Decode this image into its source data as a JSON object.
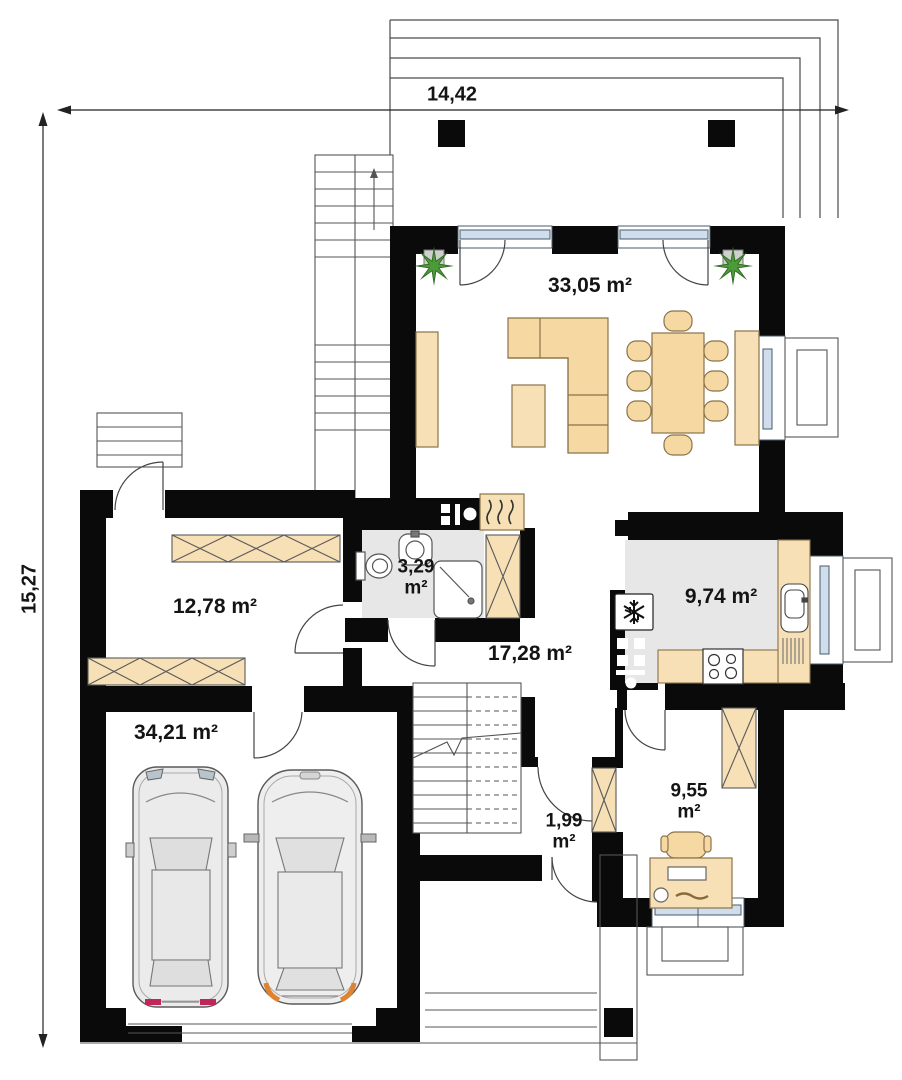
{
  "plan": {
    "dimensions": {
      "width_label": "14,42",
      "height_label": "15,27"
    },
    "rooms": {
      "living_dining": {
        "area_label": "33,05 m²"
      },
      "bedroom": {
        "area_label": "12,78 m²"
      },
      "bathroom": {
        "area_value": "3,29",
        "area_unit": "m²"
      },
      "hall": {
        "area_label": "17,28 m²"
      },
      "kitchen": {
        "area_label": "9,74 m²"
      },
      "garage": {
        "area_label": "34,21 m²"
      },
      "vestibule": {
        "area_value": "1,99",
        "area_unit": "m²"
      },
      "office": {
        "area_value": "9,55",
        "area_unit": "m²"
      }
    },
    "icons": {
      "plant": "potted-plant-icon",
      "snowflake": "fridge-snowflake-icon",
      "heat_waves": "heater-flue-icon"
    },
    "colors": {
      "wall": "#0a0a0a",
      "furniture_tan": "#f7e0b6",
      "sofa_tan": "#f6d8a2",
      "floor_gray": "#e7e7e7",
      "window_blue": "#cfdded",
      "plant_green": "#3f8c2e",
      "accent_red": "#c2255a",
      "accent_orange": "#e0832f"
    }
  }
}
